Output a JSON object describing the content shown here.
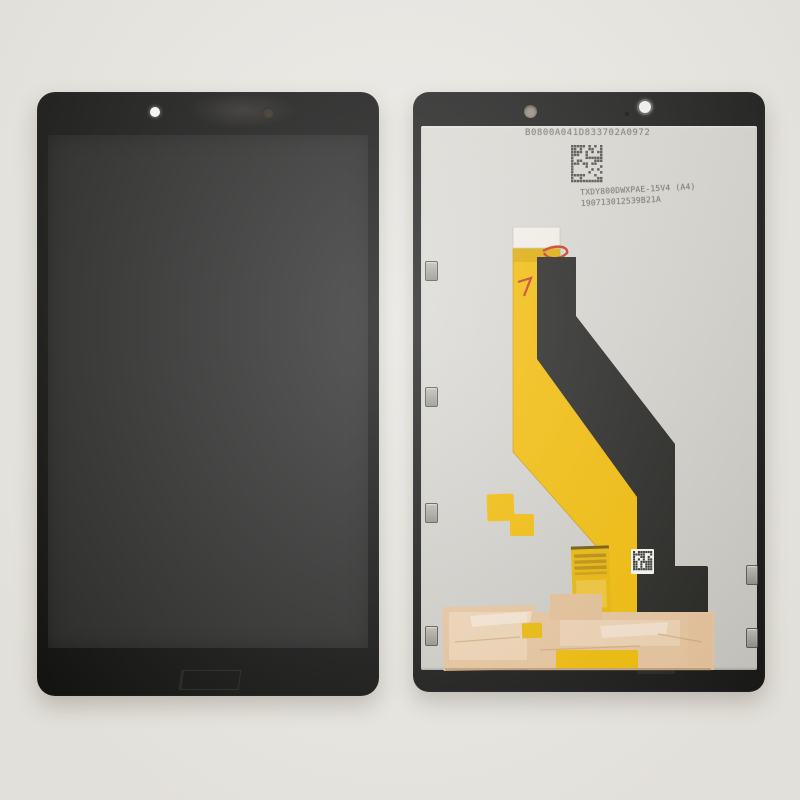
{
  "scene": {
    "subject": "Tablet LCD touch screen digitizer assembly replacement part, front view and back view"
  },
  "colors": {
    "bg": "#ebe9e4",
    "bezel": "#0c0c0c",
    "screen": "#242424",
    "frame": "#161616",
    "platelight": "#dddcd7",
    "platedark": "#c6c5c0",
    "flexyellow": "#f2ba00",
    "flexblack": "#1d1d1b",
    "tape": "#e7c49c",
    "tapelight": "#f4ddc2",
    "clip": "#aaa89f",
    "printtext": "#807e78",
    "redmark": "#c5331c"
  },
  "back_panel": {
    "serial_number": "B0800A041D833702A0972",
    "part_number": "TXDY800DWXPAE-15V4 (A4)",
    "batch_number": "190713012539B21A"
  }
}
